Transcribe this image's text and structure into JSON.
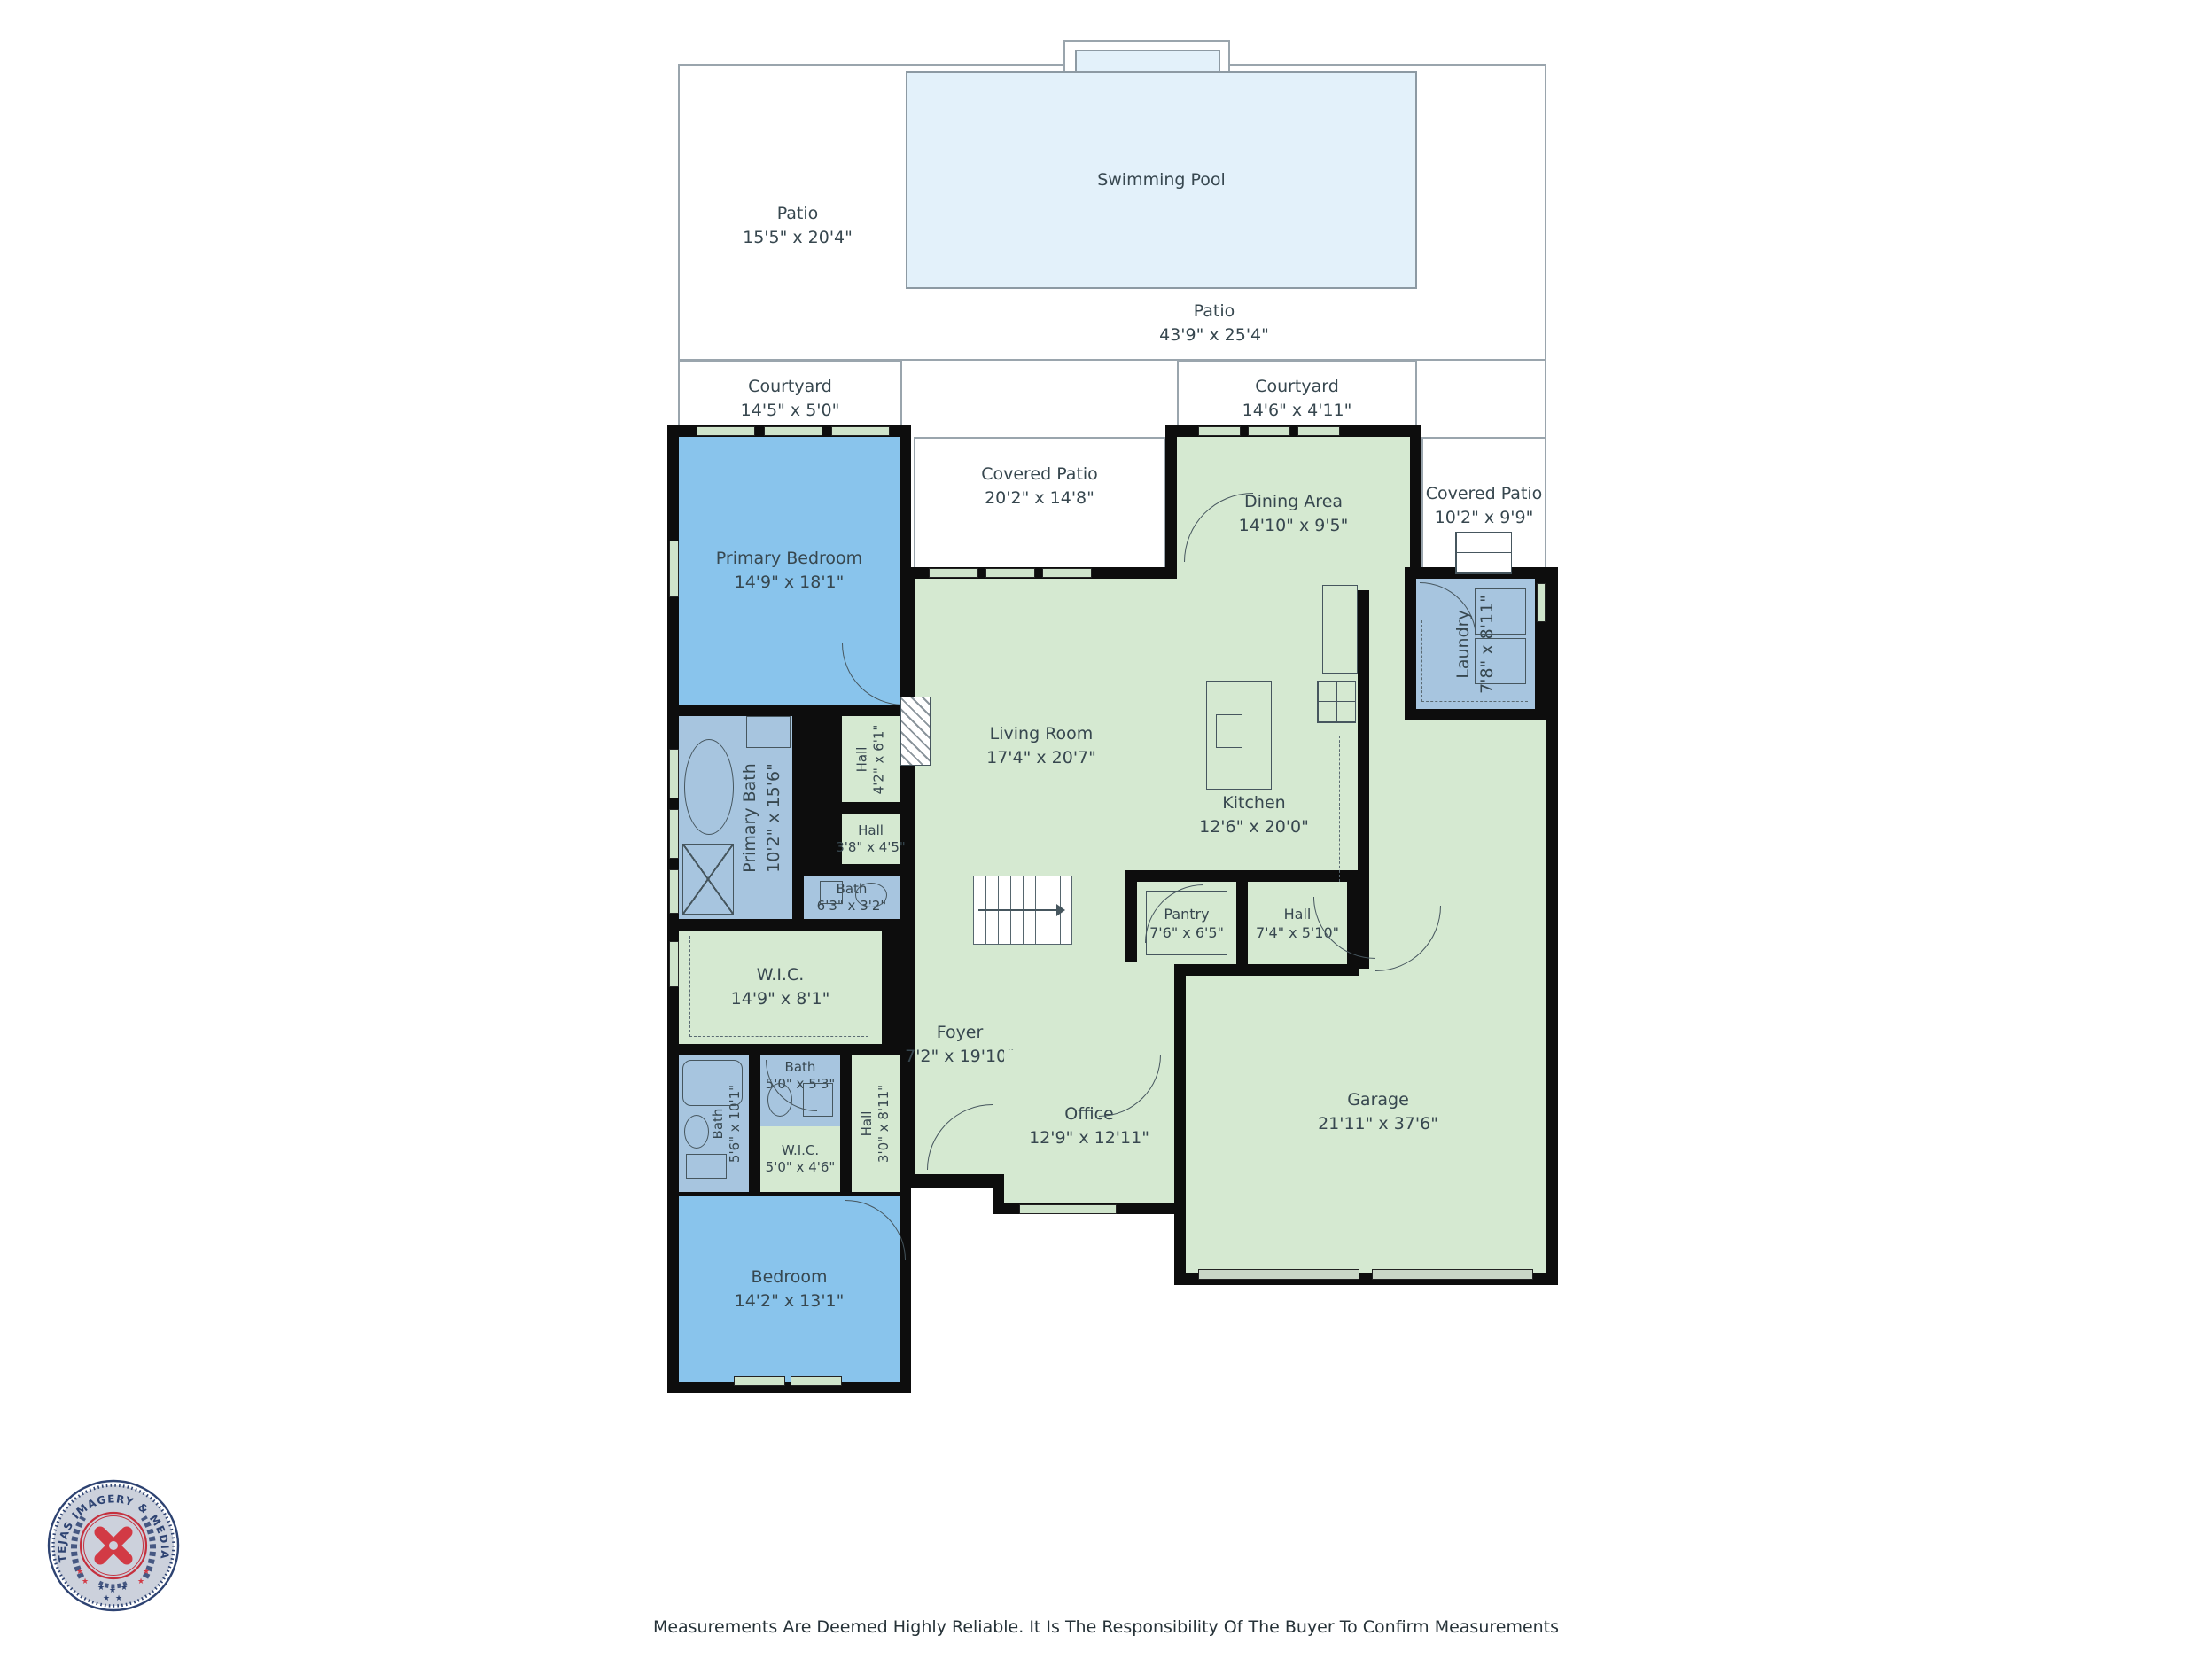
{
  "outdoor": {
    "patio_left": {
      "name": "Patio",
      "dims": "15'5\" x 20'4\""
    },
    "patio_main": {
      "name": "Patio",
      "dims": "43'9\" x 25'4\""
    },
    "swimming_pool": {
      "name": "Swimming Pool"
    },
    "courtyard_left": {
      "name": "Courtyard",
      "dims": "14'5\" x 5'0\""
    },
    "courtyard_right": {
      "name": "Courtyard",
      "dims": "14'6\" x 4'11\""
    },
    "covered_patio_center": {
      "name": "Covered Patio",
      "dims": "20'2\" x 14'8\""
    },
    "covered_patio_right": {
      "name": "Covered Patio",
      "dims": "10'2\" x 9'9\""
    }
  },
  "rooms": {
    "primary_bedroom": {
      "name": "Primary Bedroom",
      "dims": "14'9\" x 18'1\""
    },
    "dining_area": {
      "name": "Dining Area",
      "dims": "14'10\" x 9'5\""
    },
    "living_room": {
      "name": "Living Room",
      "dims": "17'4\" x 20'7\""
    },
    "kitchen": {
      "name": "Kitchen",
      "dims": "12'6\" x 20'0\""
    },
    "laundry": {
      "name": "Laundry",
      "dims": "7'8\" x 8'11\""
    },
    "pantry": {
      "name": "Pantry",
      "dims": "7'6\" x 6'5\""
    },
    "hall_center": {
      "name": "Hall",
      "dims": "7'4\" x 5'10\""
    },
    "hall_upper": {
      "name": "Hall",
      "dims": "4'2\" x 6'1\""
    },
    "hall_mid": {
      "name": "Hall",
      "dims": "3'8\" x 4'5\""
    },
    "bath_upper": {
      "name": "Bath",
      "dims": "6'3\" x 3'2\""
    },
    "primary_bath": {
      "name": "Primary Bath",
      "dims": "10'2\" x 15'6\""
    },
    "wic_main": {
      "name": "W.I.C.",
      "dims": "14'9\" x 8'1\""
    },
    "bath_small": {
      "name": "Bath",
      "dims": "5'0\" x 5'3\""
    },
    "bath_lower": {
      "name": "Bath",
      "dims": "5'6\" x 10'1\""
    },
    "wic_small": {
      "name": "W.I.C.",
      "dims": "5'0\" x 4'6\""
    },
    "hall_lower": {
      "name": "Hall",
      "dims": "3'0\" x 8'11\""
    },
    "bedroom": {
      "name": "Bedroom",
      "dims": "14'2\" x 13'1\""
    },
    "foyer": {
      "name": "Foyer",
      "dims": "7'2\" x 19'10\""
    },
    "office": {
      "name": "Office",
      "dims": "12'9\" x 12'11\""
    },
    "garage": {
      "name": "Garage",
      "dims": "21'11\" x 37'6\""
    }
  },
  "logo": {
    "arc_text": "TEJAS IMAGERY & MEDIA SERVICES"
  },
  "footer": {
    "disclaimer": "Measurements Are Deemed Highly Reliable. It Is The Responsibility Of The Buyer To Confirm Measurements"
  },
  "colors": {
    "room_green": "#d5e9d1",
    "bedroom_blue": "#89c4ec",
    "bath_blue": "#a7c5df",
    "pool_blue": "#e3f1fa",
    "wall": "#0d0d0d",
    "label_text": "#37474f",
    "logo_navy": "#2e4372",
    "logo_red": "#d23a45"
  }
}
